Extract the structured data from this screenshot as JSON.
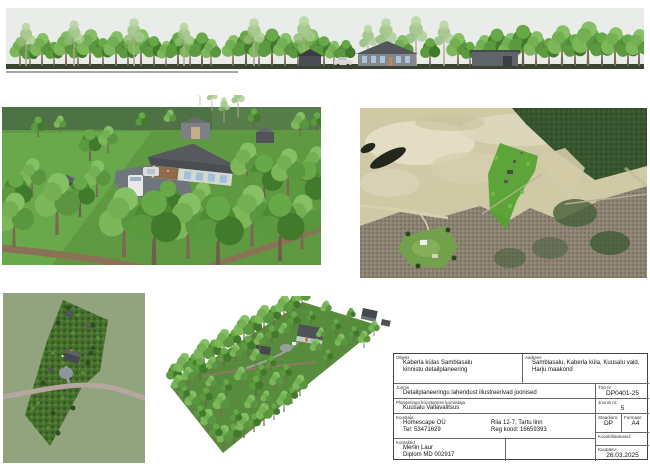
{
  "title_block": {
    "objekt": {
      "label": "Objekt",
      "line1": "Kaberla külas Samblasalu",
      "line2": "kinnistu detailplaneering"
    },
    "aadress": {
      "label": "Aadress",
      "line1": "Samblasalu, Kaberla küla, Kuusalu vald,",
      "line2": "Harju maakond"
    },
    "joonis": {
      "label": "Joonis",
      "value": "Detailplaneeringu lahendust illustreerivad joonised"
    },
    "too_nr": {
      "label": "Töö nr:",
      "value": "DP0401-25"
    },
    "korraldaja": {
      "label": "Planeeringu koostamise korraldaja",
      "value": "Kuusalu Vallavalitsus"
    },
    "joonis_nr": {
      "label": "Joonis nr:",
      "value": "5"
    },
    "koostaja": {
      "label": "Koostaja",
      "company": "Homescape OÜ",
      "address": "Riia 12-7, Tartu linn",
      "phone": "Tel: 53471629",
      "reg_code": "Reg kood: 16659393"
    },
    "staadium": {
      "label": "Staadium:",
      "value": "DP"
    },
    "formaat": {
      "label": "Formaat:",
      "value": "A4"
    },
    "kooskolastused": {
      "label": "Kooskõlastused:"
    },
    "kontaktid": {
      "label": "Kontaktid",
      "line1": "Merlin Laur",
      "line2": "Diplom MD 002917"
    },
    "kuupaev": {
      "label": "Kuupäev:",
      "value": "26.03.2025"
    }
  },
  "palette": {
    "sky": "#e9ece9",
    "lawn": "#5f9a43",
    "forest_band": "#4d7345",
    "parcel_highlight": "#54a22f",
    "aerial_field": "#cfc9a6",
    "aerial_forest": "#8b8272",
    "plan_background": "#92a47e",
    "plan_parcel": "#47702e",
    "road_brown": "#8a7257",
    "roof_gray": "#4e5256"
  }
}
